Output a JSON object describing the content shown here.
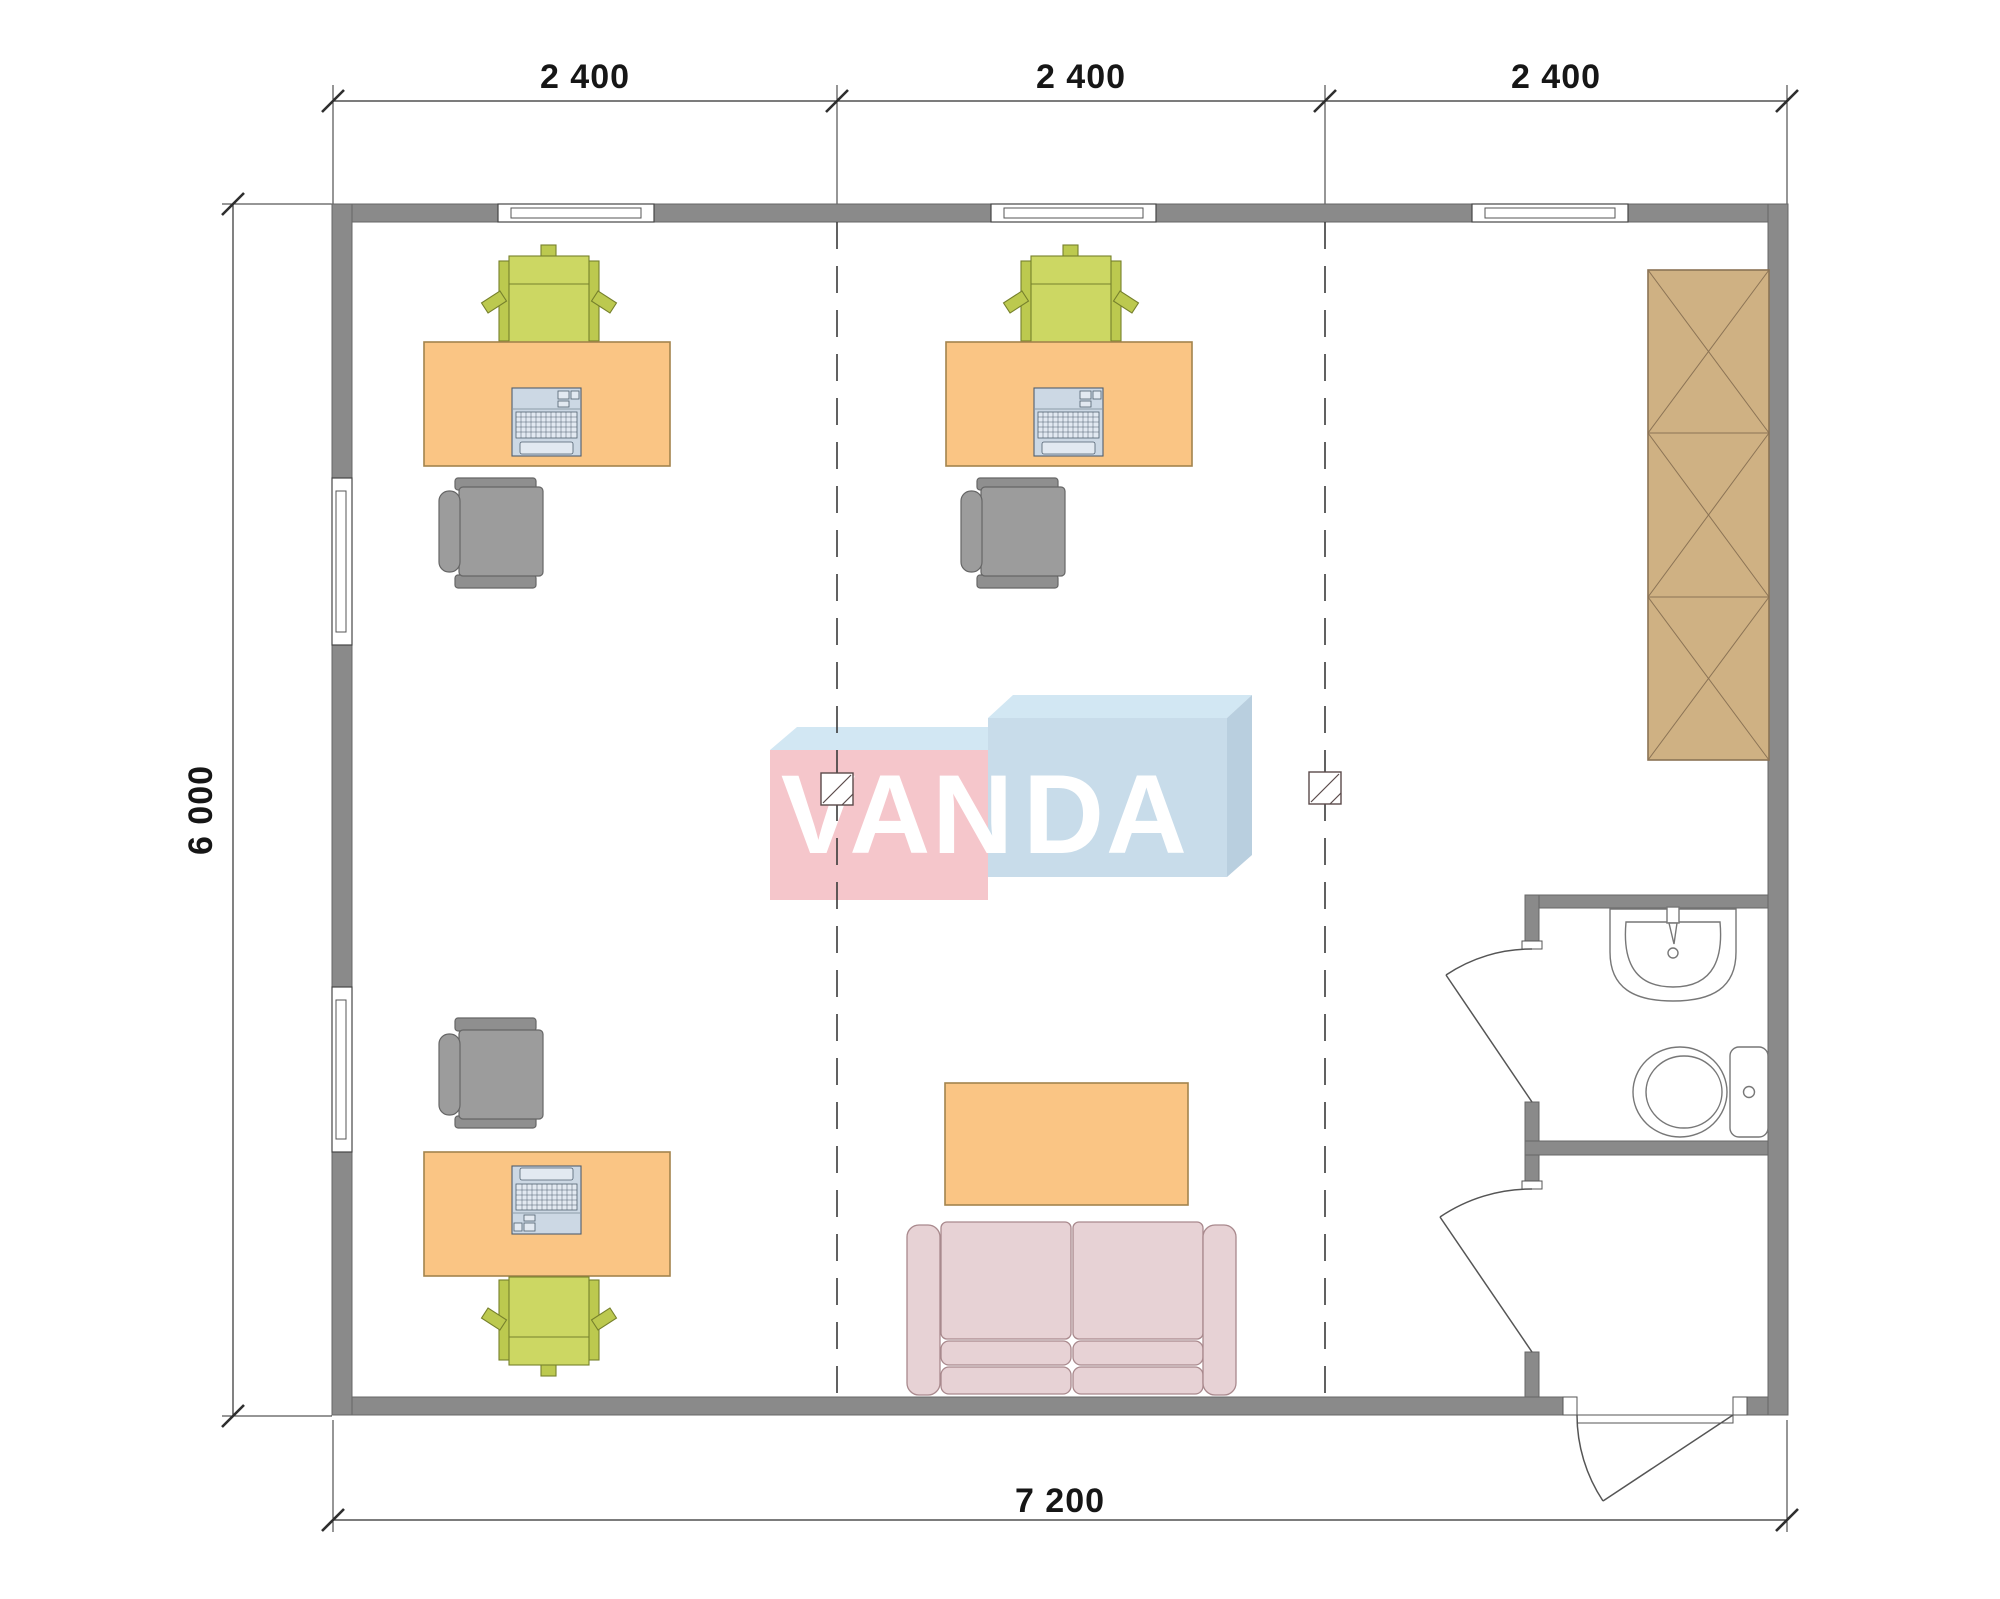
{
  "title": "Modular office floor plan with VANDA watermark",
  "palette": {
    "wall": "#8a8a8a",
    "wall_stroke": "#676767",
    "line": "#2e2e2e",
    "dash": "#3a3a3a",
    "desk": "#fac584",
    "desk_stroke": "#a3844d",
    "chair_green": "#ccd763",
    "chair_green_dark": "#bcc94f",
    "chair_green_stroke": "#76802c",
    "chair_gray": "#9c9c9c",
    "chair_gray_dark": "#8f8f8f",
    "chair_gray_stroke": "#666666",
    "wardrobe": "#cfb183",
    "wardrobe_stroke": "#8b7355",
    "sofa": "#e7d2d5",
    "sofa_stroke": "#a9898d",
    "fixture_stroke": "#777777",
    "laptop": "#ccd8e4",
    "laptop_stroke": "#4f5f6f",
    "logo_pink": "#f5c6cb",
    "logo_blue": "#c8dcea",
    "logo_top": "#d2e7f3",
    "logo_side": "#b9cfdf"
  },
  "dimensions": {
    "top": [
      "2 400",
      "2 400",
      "2 400"
    ],
    "left": "6 000",
    "bottom": "7 200"
  },
  "watermark": {
    "left": "VAN",
    "right": "DA"
  },
  "plan_symbols": [
    "window",
    "door-swing",
    "desk",
    "laptop-icon",
    "visitor-chair-icon",
    "office-chair-icon",
    "wardrobe-icon",
    "sofa-icon",
    "coffee-table",
    "sink-icon",
    "toilet-icon",
    "floor-drain-icon",
    "module-grid-line"
  ]
}
